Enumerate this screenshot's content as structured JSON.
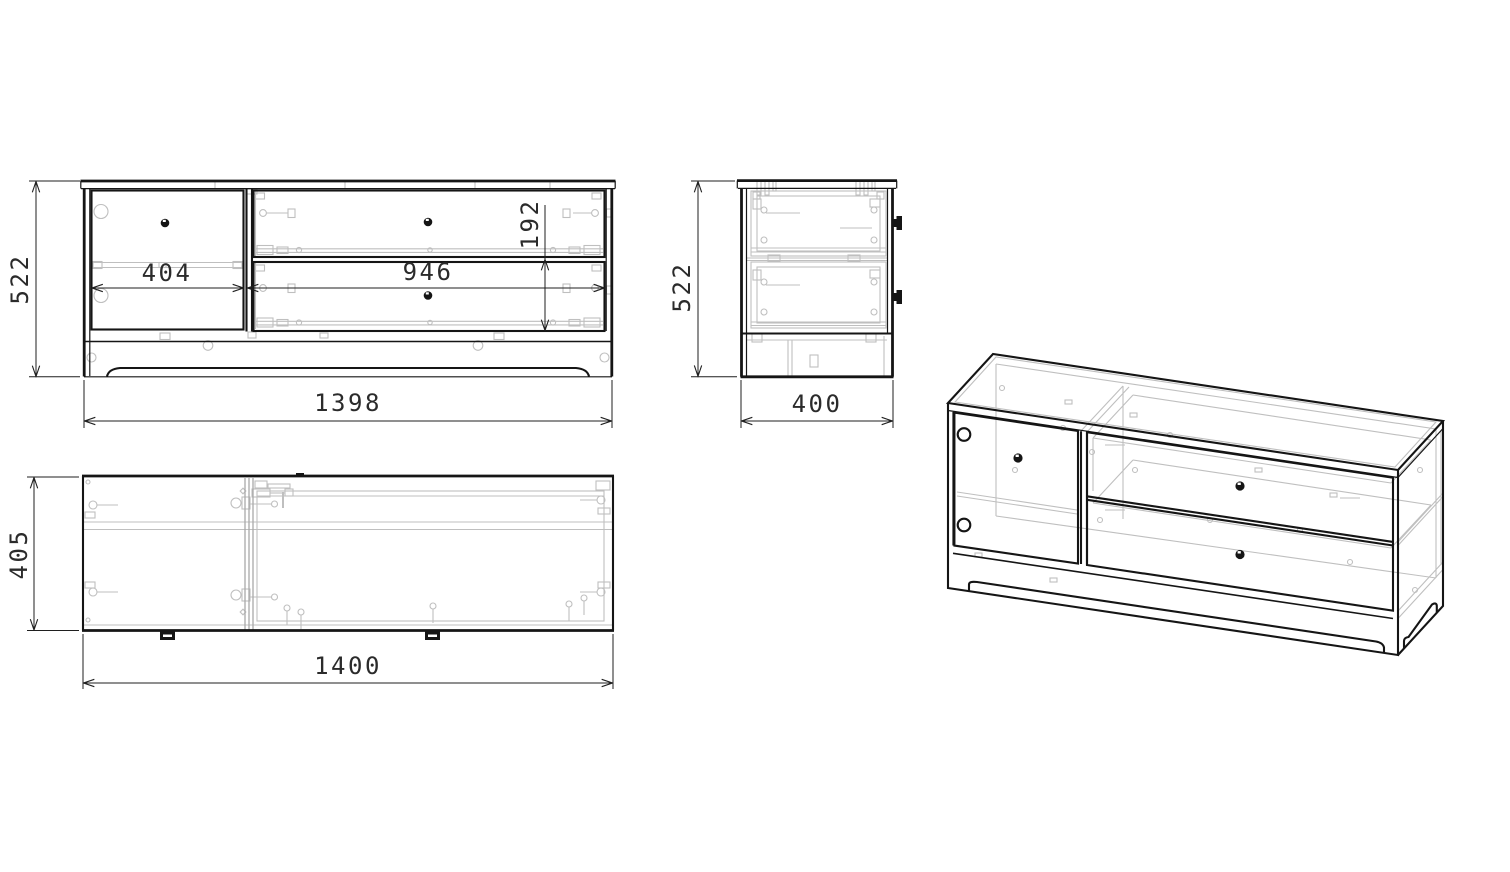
{
  "drawing": {
    "background": "#ffffff",
    "line_color": "#151515",
    "detail_color": "#bfbfbf",
    "views": {
      "front": {
        "label": "front-view",
        "height_mm": "522",
        "door_width_mm": "404",
        "drawer_width_mm": "946",
        "drawer_front_height_mm": "192",
        "overall_width_mm": "1398"
      },
      "side": {
        "label": "side-view",
        "height_mm": "522",
        "depth_mm": "400"
      },
      "plan": {
        "label": "plan-view",
        "depth_mm": "405",
        "overall_width_mm": "1400"
      },
      "iso": {
        "label": "isometric-view"
      }
    }
  }
}
